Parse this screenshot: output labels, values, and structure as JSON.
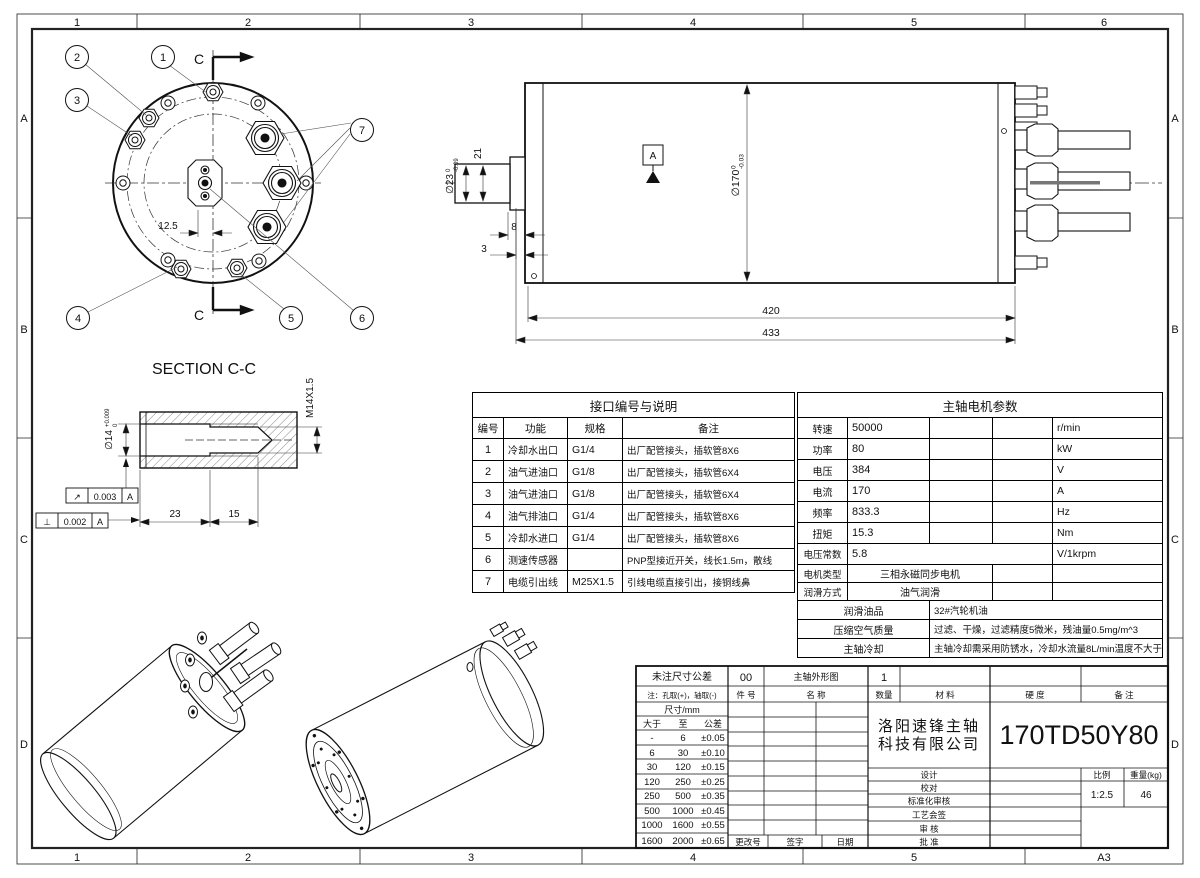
{
  "sheet": {
    "size": "A3",
    "zones_top": [
      "1",
      "2",
      "3",
      "4",
      "5",
      "6"
    ],
    "zones_bottom": [
      "1",
      "2",
      "3",
      "4",
      "5"
    ],
    "zones_side": [
      "A",
      "B",
      "C",
      "D"
    ]
  },
  "front_view": {
    "section_label": "C",
    "callouts": [
      "1",
      "2",
      "3",
      "4",
      "5",
      "6",
      "7"
    ],
    "offset_dim": "12.5"
  },
  "side_view": {
    "datum": "A",
    "dia_shaft": {
      "v": "∅23",
      "sup": "0",
      "sub": "-0.09"
    },
    "dia_body": {
      "v": "∅170",
      "sup": "0",
      "sub": "-0.03"
    },
    "len_shaft": "21",
    "len_body": "420",
    "len_total": "433",
    "dim_step": "8",
    "dim_face": "3"
  },
  "section_view": {
    "title": "SECTION C-C",
    "thread": "M14X1.5",
    "dia_bore": {
      "v": "∅14",
      "sup": "+0.009",
      "sub": "0"
    },
    "len_bore": "23",
    "len_thread": "15",
    "gdt": [
      {
        "sym": "↗",
        "tol": "0.003",
        "datum": "A"
      },
      {
        "sym": "⊥",
        "tol": "0.002",
        "datum": "A"
      }
    ]
  },
  "interface_table": {
    "title": "接口编号与说明",
    "headers": [
      "编号",
      "功能",
      "规格",
      "备注"
    ],
    "rows": [
      [
        "1",
        "冷却水出口",
        "G1/4",
        "出厂配管接头，插软管8X6"
      ],
      [
        "2",
        "油气进油口",
        "G1/8",
        "出厂配管接头，插软管6X4"
      ],
      [
        "3",
        "油气进油口",
        "G1/8",
        "出厂配管接头，插软管6X4"
      ],
      [
        "4",
        "油气排油口",
        "G1/4",
        "出厂配管接头，插软管8X6"
      ],
      [
        "5",
        "冷却水进口",
        "G1/4",
        "出厂配管接头，插软管8X6"
      ],
      [
        "6",
        "测速传感器",
        "",
        "PNP型接近开关，线长1.5m，散线"
      ],
      [
        "7",
        "电缆引出线",
        "M25X1.5",
        "引线电缆直接引出，接铜线鼻"
      ]
    ]
  },
  "motor_table": {
    "title": "主轴电机参数",
    "rows": [
      {
        "label": "转速",
        "value": "50000",
        "unit": "r/min"
      },
      {
        "label": "功率",
        "value": "80",
        "unit": "kW"
      },
      {
        "label": "电压",
        "value": "384",
        "unit": "V"
      },
      {
        "label": "电流",
        "value": "170",
        "unit": "A"
      },
      {
        "label": "频率",
        "value": "833.3",
        "unit": "Hz"
      },
      {
        "label": "扭矩",
        "value": "15.3",
        "unit": "Nm"
      }
    ],
    "voltage_constant": {
      "label": "电压常数",
      "value": "5.8",
      "unit": "V/1krpm"
    },
    "motor_type": {
      "label": "电机类型",
      "value": "三相永磁同步电机"
    },
    "lube_method": {
      "label": "润滑方式",
      "value": "油气润滑"
    },
    "info_rows": [
      {
        "label": "润滑油品",
        "value": "32#汽轮机油"
      },
      {
        "label": "压缩空气质量",
        "value": "过滤、干燥，过滤精度5微米，残油量0.5mg/m^3"
      },
      {
        "label": "主轴冷却",
        "value": "主轴冷却需采用防锈水，冷却水流量8L/min温度不大于25度。"
      }
    ]
  },
  "title_block": {
    "tol_title": "未注尺寸公差",
    "note": "注：孔取(+)，轴取(-)",
    "dim_unit": "尺寸/mm",
    "tol_headers": [
      "大于",
      "至",
      "公差"
    ],
    "tol_rows": [
      [
        "-",
        "6",
        "±0.05"
      ],
      [
        "6",
        "30",
        "±0.10"
      ],
      [
        "30",
        "120",
        "±0.15"
      ],
      [
        "120",
        "250",
        "±0.25"
      ],
      [
        "250",
        "500",
        "±0.35"
      ],
      [
        "500",
        "1000",
        "±0.45"
      ],
      [
        "1000",
        "1600",
        "±0.55"
      ],
      [
        "1600",
        "2000",
        "±0.65"
      ]
    ],
    "item_no": "00",
    "item_name": "主轴外形图",
    "qty": "1",
    "headers": {
      "part_no": "件  号",
      "name": "名    称",
      "qty": "数量",
      "material": "材  料",
      "hardness": "硬  度",
      "remark": "备  注"
    },
    "company_line1": "洛阳速锋主轴",
    "company_line2": "科技有限公司",
    "part_number": "170TD50Y80",
    "sign_labels": [
      "设计",
      "校对",
      "标准化审核",
      "工艺会签",
      "审  核",
      "批  准"
    ],
    "change_labels": [
      "更改号",
      "签字",
      "日期"
    ],
    "scale_label": "比例",
    "weight_label": "重量(kg)",
    "scale": "1:2.5",
    "weight": "46"
  }
}
